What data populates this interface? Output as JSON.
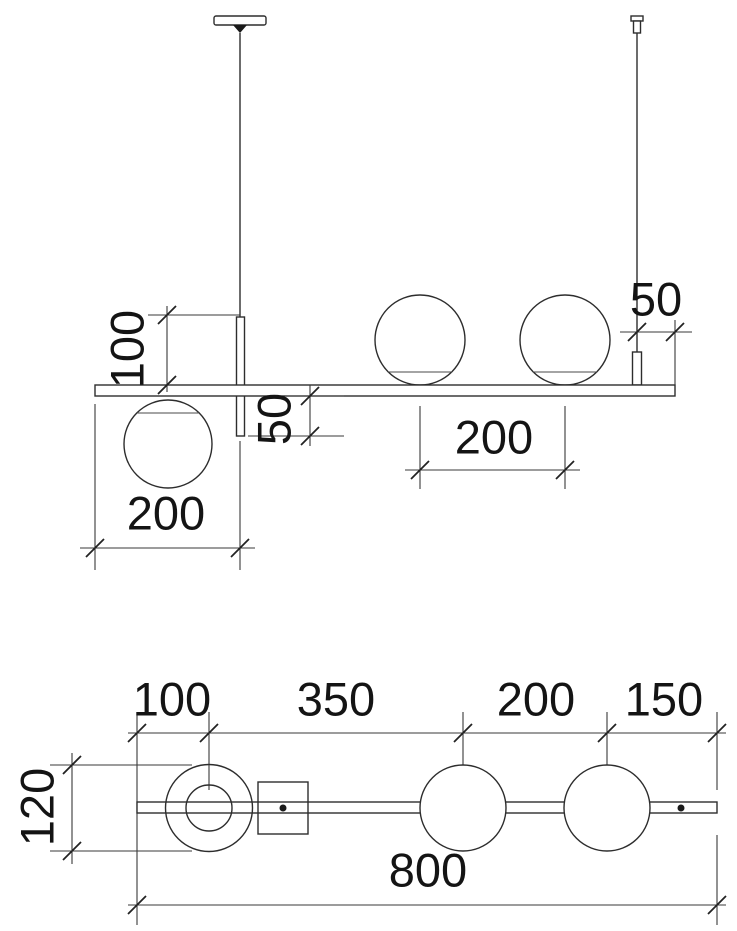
{
  "drawing": {
    "kind": "technical-dimension-drawing",
    "subject": "linear pendant lamp with glass spheres — front elevation (top) and plan view (bottom)",
    "colors": {
      "line": "#2d2d2d",
      "text": "#141414",
      "background": "#ffffff"
    },
    "front_view": {
      "dim_rod_above_bar": "100",
      "dim_rod_below_bar": "50",
      "dim_left_sphere_offset": "200",
      "dim_upper_sphere_spacing": "200",
      "dim_cable_inset_from_end": "50"
    },
    "plan_view": {
      "dim_end_to_ring": "100",
      "dim_ring_to_sphere": "350",
      "dim_sphere_spacing": "200",
      "dim_sphere_to_end": "150",
      "dim_sphere_diameter": "120",
      "dim_total_length": "800"
    }
  }
}
